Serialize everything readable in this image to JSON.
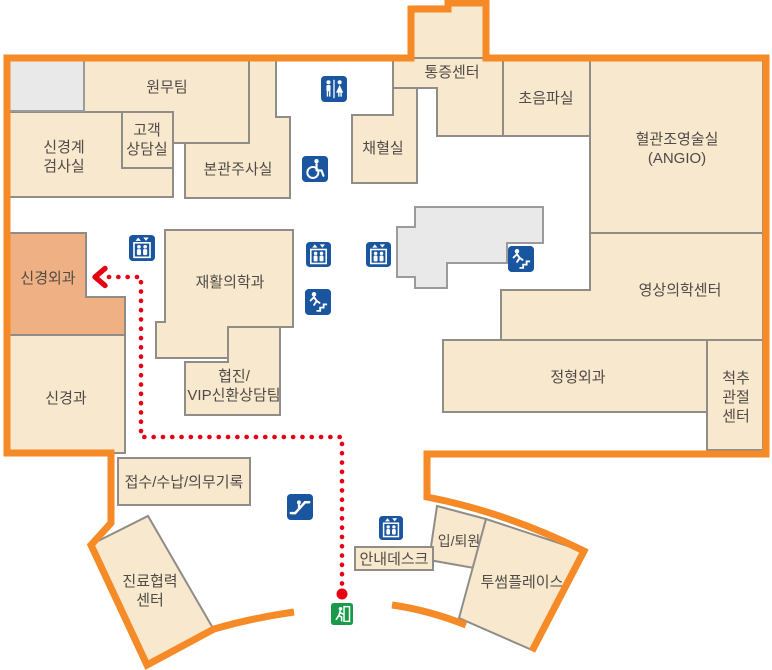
{
  "colors": {
    "boundary_orange": "#F58A26",
    "room_beige": "#F7E8CE",
    "highlighted_room_orange": "#EFB183",
    "wall_gray": "#908D89",
    "block_gray": "#E9E9E9",
    "icon_blue": "#1A55A0",
    "exit_green": "#189A4A",
    "route_red": "#E60012",
    "label_text": "#504B46"
  },
  "rooms": {
    "admin_team": {
      "label": "원무팀"
    },
    "neuro_exam": {
      "line1": "신경계",
      "line2": "검사실"
    },
    "customer_consult": {
      "line1": "고객",
      "line2": "상담실"
    },
    "main_injection": {
      "label": "본관주사실"
    },
    "blood_collection": {
      "label": "채혈실"
    },
    "pain_center": {
      "label": "통증센터"
    },
    "ultrasound": {
      "label": "초음파실"
    },
    "angiography": {
      "line1": "혈관조영술실",
      "line2": "(ANGIO)"
    },
    "neurosurgery": {
      "label": "신경외과",
      "highlighted": true
    },
    "rehab_medicine": {
      "label": "재활의학과"
    },
    "coop_vip": {
      "line1": "협진/",
      "line2": "VIP신환상담팀"
    },
    "neurology": {
      "label": "신경과"
    },
    "imaging_center": {
      "label": "영상의학센터"
    },
    "orthopedics": {
      "label": "정형외과"
    },
    "spine_joint": {
      "line1": "척추",
      "line2": "관절",
      "line3": "센터"
    },
    "reception": {
      "label": "접수/수납/의무기록"
    },
    "care_coop": {
      "line1": "진료협력",
      "line2": "센터"
    },
    "info_desk": {
      "label": "안내데스크"
    },
    "admission_discharge": {
      "label": "입/퇴원"
    },
    "twosome_place": {
      "label": "투썸플레이스"
    }
  },
  "icons": [
    {
      "name": "restroom-icon"
    },
    {
      "name": "wheelchair-accessible-icon"
    },
    {
      "name": "elevator-icon"
    },
    {
      "name": "elevator-icon"
    },
    {
      "name": "elevator-icon"
    },
    {
      "name": "elevator-icon"
    },
    {
      "name": "stairs-icon"
    },
    {
      "name": "stairs-icon"
    },
    {
      "name": "escalator-icon"
    },
    {
      "name": "emergency-exit-icon"
    }
  ]
}
